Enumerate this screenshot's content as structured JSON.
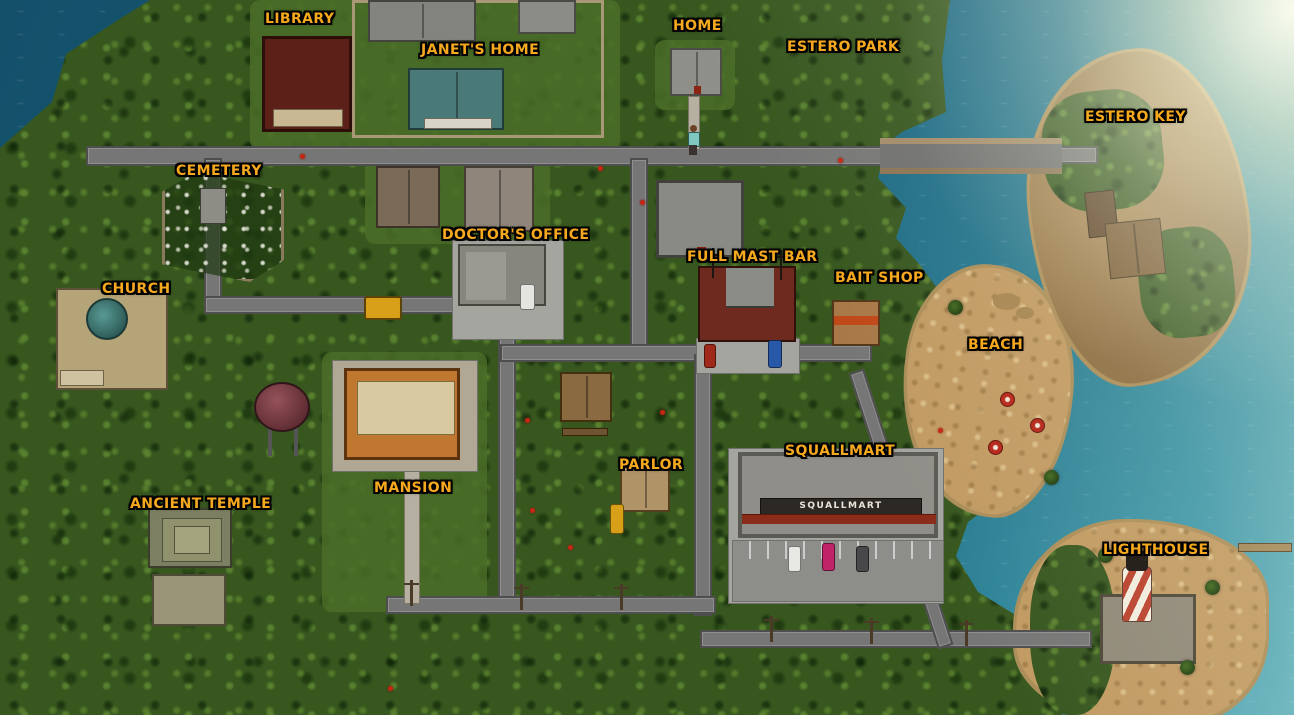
{
  "map": {
    "title": "Island town map",
    "locations": [
      {
        "name": "library",
        "label": "LIBRARY"
      },
      {
        "name": "janets-home",
        "label": "JANET'S HOME"
      },
      {
        "name": "home",
        "label": "HOME"
      },
      {
        "name": "estero-park",
        "label": "ESTERO PARK"
      },
      {
        "name": "estero-key",
        "label": "ESTERO KEY"
      },
      {
        "name": "cemetery",
        "label": "CEMETERY"
      },
      {
        "name": "doctors-office",
        "label": "DOCTOR'S OFFICE"
      },
      {
        "name": "full-mast-bar",
        "label": "FULL MAST BAR"
      },
      {
        "name": "bait-shop",
        "label": "BAIT SHOP"
      },
      {
        "name": "church",
        "label": "CHURCH"
      },
      {
        "name": "beach",
        "label": "BEACH"
      },
      {
        "name": "mansion",
        "label": "MANSION"
      },
      {
        "name": "parlor",
        "label": "PARLOR"
      },
      {
        "name": "squallmart",
        "label": "SQUALLMART"
      },
      {
        "name": "ancient-temple",
        "label": "ANCIENT TEMPLE"
      },
      {
        "name": "lighthouse",
        "label": "LIGHTHOUSE"
      }
    ],
    "signs": {
      "squallmart_storefront": "SQUALLMART"
    },
    "colors": {
      "label_gold": "#f6a81e",
      "label_outline": "#000000",
      "ocean_deep": "#14506a",
      "ocean_light": "#63b2bd",
      "jungle": "#37571f",
      "sand": "#c19a62",
      "road": "#767676"
    }
  }
}
